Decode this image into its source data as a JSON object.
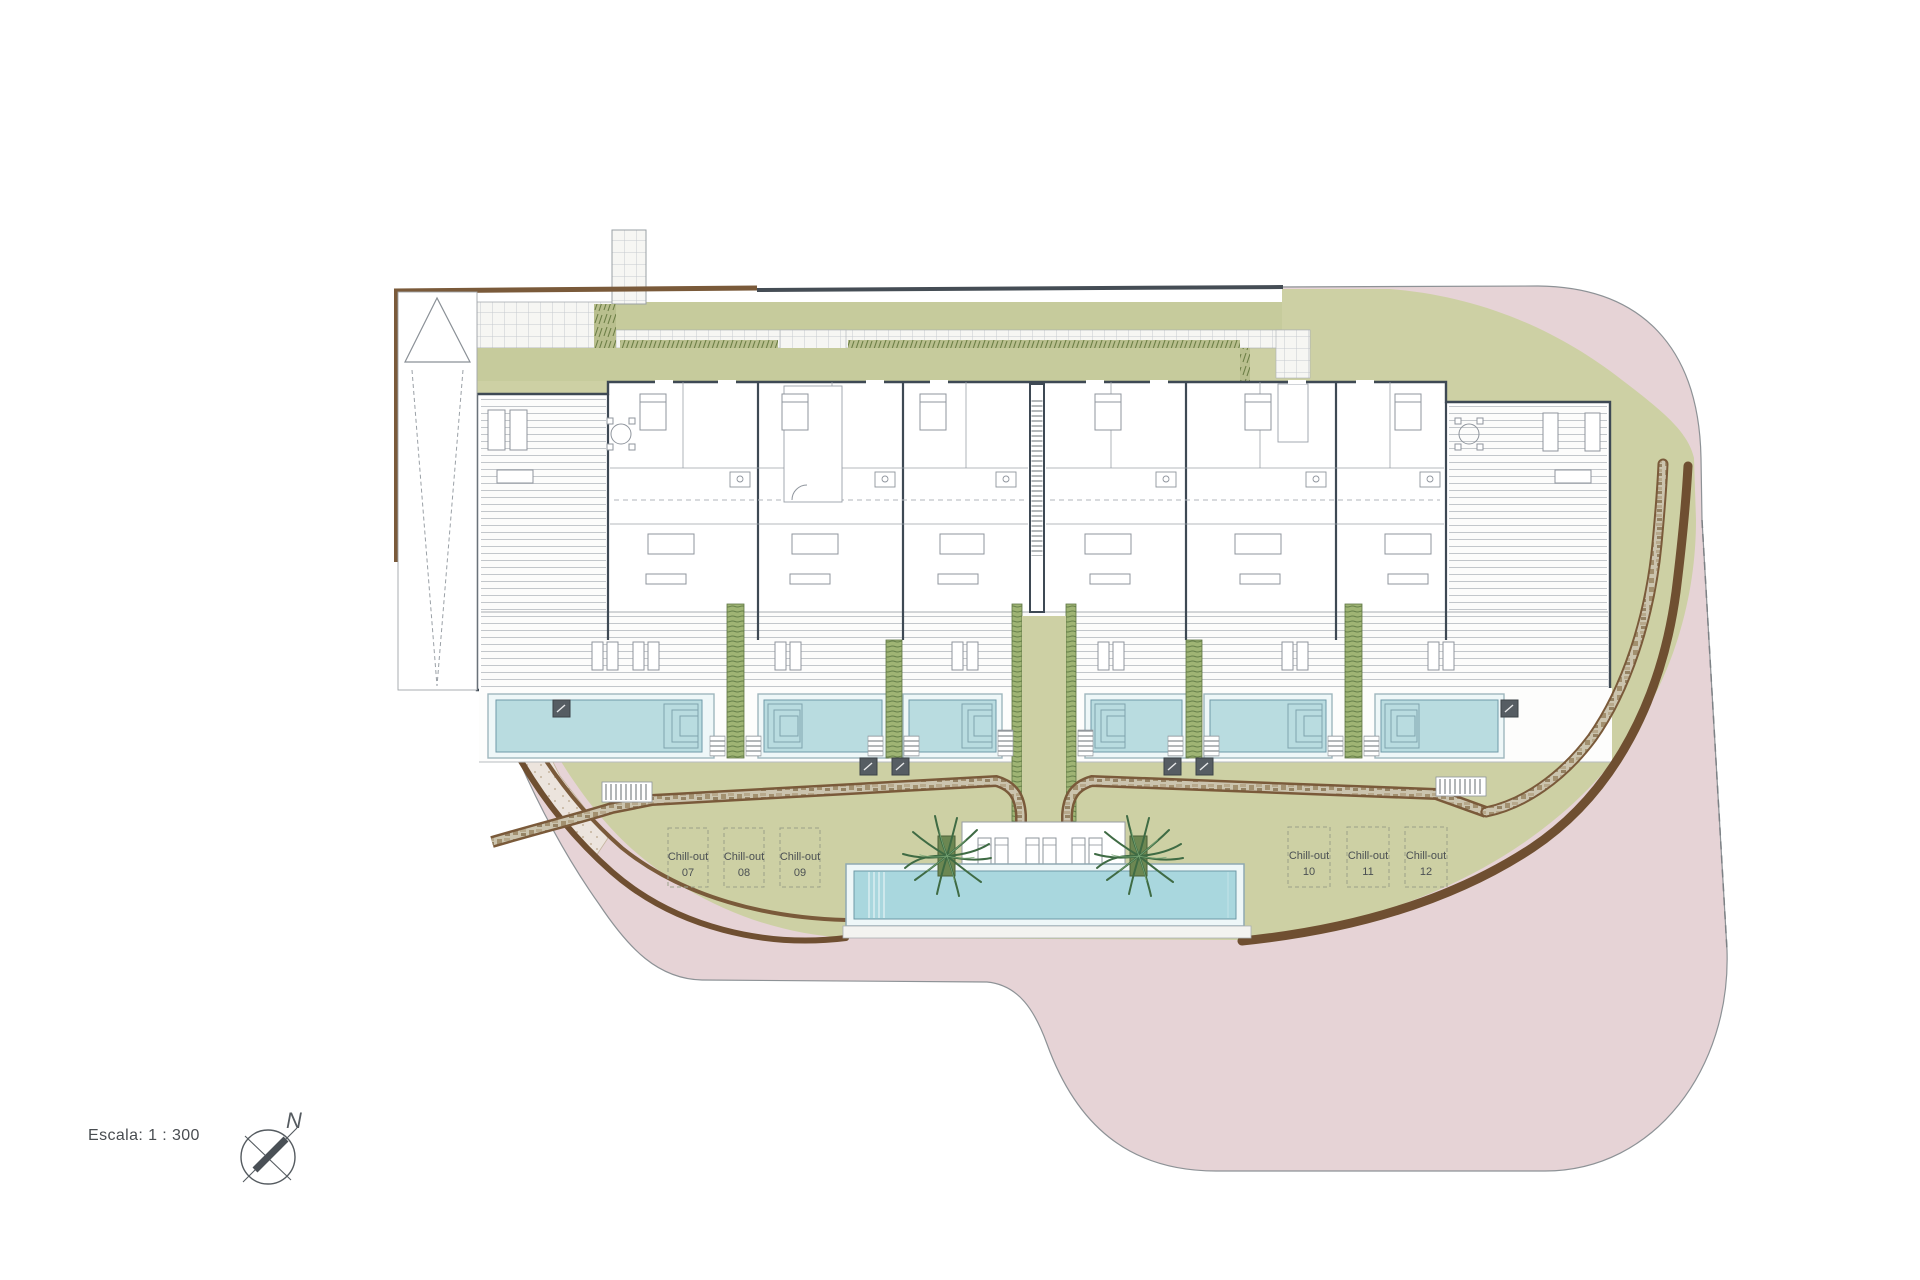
{
  "plan": {
    "title": "Residential site plan",
    "scale_label": "Escala: 1 : 300",
    "compass": {
      "north_label": "N"
    },
    "chill_outs": [
      {
        "name": "Chill-out",
        "number": "07"
      },
      {
        "name": "Chill-out",
        "number": "08"
      },
      {
        "name": "Chill-out",
        "number": "09"
      },
      {
        "name": "Chill-out",
        "number": "10"
      },
      {
        "name": "Chill-out",
        "number": "11"
      },
      {
        "name": "Chill-out",
        "number": "12"
      }
    ],
    "colors": {
      "paving_pink": "#e6d3d6",
      "lawn_green": "#cdd0a4",
      "pool_blue": "#a9d7de",
      "private_pool_blue": "#b9dce0",
      "retaining_wall_brown": "#7a5a3a",
      "building_wall": "#3e4954"
    }
  }
}
